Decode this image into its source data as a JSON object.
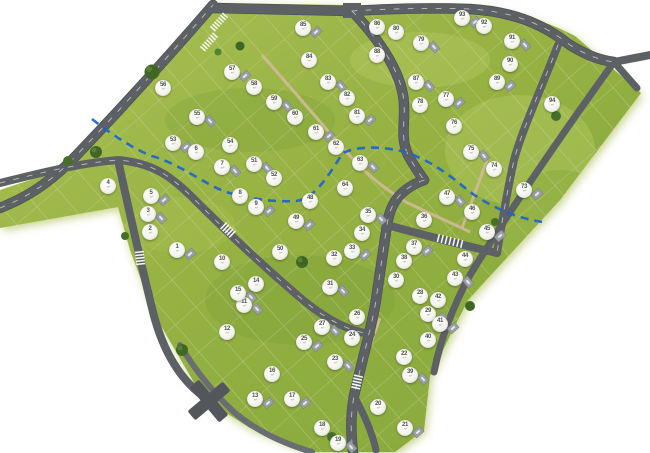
{
  "site_plan": {
    "canvas": {
      "width": 650,
      "height": 453
    },
    "colors": {
      "background": "#ffffff",
      "grass": "#96b243",
      "grass_light": "#b3c75e",
      "grass_dark": "#7fa238",
      "road": "#5d6165",
      "road_secondary": "#6a6e72",
      "footpath": "#cdbb92",
      "utility_line_blue": "#1d64cc",
      "marker_fill": "#f4f4ee",
      "marker_text": "#4e5347",
      "tree": "#46702a"
    },
    "marker_sub_label": "m²",
    "lots": [
      {
        "n": "1",
        "x": 177,
        "y": 250
      },
      {
        "n": "2",
        "x": 150,
        "y": 232
      },
      {
        "n": "3",
        "x": 148,
        "y": 214
      },
      {
        "n": "4",
        "x": 108,
        "y": 186
      },
      {
        "n": "5",
        "x": 151,
        "y": 196
      },
      {
        "n": "6",
        "x": 196,
        "y": 152
      },
      {
        "n": "7",
        "x": 222,
        "y": 167
      },
      {
        "n": "8",
        "x": 240,
        "y": 196
      },
      {
        "n": "9",
        "x": 256,
        "y": 207
      },
      {
        "n": "10",
        "x": 222,
        "y": 262
      },
      {
        "n": "11",
        "x": 244,
        "y": 305
      },
      {
        "n": "12",
        "x": 227,
        "y": 332
      },
      {
        "n": "13",
        "x": 255,
        "y": 399
      },
      {
        "n": "14",
        "x": 256,
        "y": 284
      },
      {
        "n": "15",
        "x": 238,
        "y": 293
      },
      {
        "n": "16",
        "x": 272,
        "y": 374
      },
      {
        "n": "17",
        "x": 292,
        "y": 399
      },
      {
        "n": "18",
        "x": 322,
        "y": 428
      },
      {
        "n": "19",
        "x": 338,
        "y": 443
      },
      {
        "n": "20",
        "x": 378,
        "y": 407
      },
      {
        "n": "21",
        "x": 405,
        "y": 428
      },
      {
        "n": "22",
        "x": 404,
        "y": 357
      },
      {
        "n": "23",
        "x": 335,
        "y": 362
      },
      {
        "n": "24",
        "x": 352,
        "y": 338
      },
      {
        "n": "25",
        "x": 304,
        "y": 342
      },
      {
        "n": "26",
        "x": 357,
        "y": 317
      },
      {
        "n": "27",
        "x": 322,
        "y": 327
      },
      {
        "n": "28",
        "x": 420,
        "y": 296
      },
      {
        "n": "29",
        "x": 428,
        "y": 314
      },
      {
        "n": "30",
        "x": 396,
        "y": 280
      },
      {
        "n": "31",
        "x": 330,
        "y": 287
      },
      {
        "n": "32",
        "x": 334,
        "y": 258
      },
      {
        "n": "33",
        "x": 352,
        "y": 251
      },
      {
        "n": "34",
        "x": 362,
        "y": 233
      },
      {
        "n": "35",
        "x": 368,
        "y": 215
      },
      {
        "n": "36",
        "x": 424,
        "y": 220
      },
      {
        "n": "37",
        "x": 414,
        "y": 247
      },
      {
        "n": "38",
        "x": 404,
        "y": 261
      },
      {
        "n": "39",
        "x": 410,
        "y": 375
      },
      {
        "n": "40",
        "x": 428,
        "y": 340
      },
      {
        "n": "41",
        "x": 440,
        "y": 324
      },
      {
        "n": "42",
        "x": 438,
        "y": 300
      },
      {
        "n": "43",
        "x": 455,
        "y": 278
      },
      {
        "n": "44",
        "x": 465,
        "y": 259
      },
      {
        "n": "45",
        "x": 487,
        "y": 232
      },
      {
        "n": "46",
        "x": 472,
        "y": 212
      },
      {
        "n": "47",
        "x": 447,
        "y": 197
      },
      {
        "n": "48",
        "x": 310,
        "y": 201
      },
      {
        "n": "49",
        "x": 296,
        "y": 221
      },
      {
        "n": "50",
        "x": 280,
        "y": 252
      },
      {
        "n": "51",
        "x": 254,
        "y": 164
      },
      {
        "n": "52",
        "x": 274,
        "y": 178
      },
      {
        "n": "53",
        "x": 173,
        "y": 143
      },
      {
        "n": "54",
        "x": 230,
        "y": 145
      },
      {
        "n": "55",
        "x": 197,
        "y": 117
      },
      {
        "n": "56",
        "x": 163,
        "y": 88
      },
      {
        "n": "57",
        "x": 232,
        "y": 72
      },
      {
        "n": "58",
        "x": 254,
        "y": 87
      },
      {
        "n": "59",
        "x": 274,
        "y": 102
      },
      {
        "n": "60",
        "x": 295,
        "y": 117
      },
      {
        "n": "61",
        "x": 316,
        "y": 132
      },
      {
        "n": "62",
        "x": 336,
        "y": 147
      },
      {
        "n": "63",
        "x": 360,
        "y": 163
      },
      {
        "n": "64",
        "x": 345,
        "y": 188
      },
      {
        "n": "73",
        "x": 524,
        "y": 190
      },
      {
        "n": "74",
        "x": 494,
        "y": 169
      },
      {
        "n": "75",
        "x": 471,
        "y": 152
      },
      {
        "n": "76",
        "x": 454,
        "y": 126
      },
      {
        "n": "77",
        "x": 446,
        "y": 99
      },
      {
        "n": "78",
        "x": 420,
        "y": 105
      },
      {
        "n": "79",
        "x": 421,
        "y": 43
      },
      {
        "n": "80",
        "x": 396,
        "y": 32
      },
      {
        "n": "81",
        "x": 357,
        "y": 116
      },
      {
        "n": "82",
        "x": 347,
        "y": 98
      },
      {
        "n": "83",
        "x": 328,
        "y": 82
      },
      {
        "n": "84",
        "x": 309,
        "y": 60
      },
      {
        "n": "85",
        "x": 303,
        "y": 28
      },
      {
        "n": "86",
        "x": 377,
        "y": 27
      },
      {
        "n": "87",
        "x": 416,
        "y": 82
      },
      {
        "n": "88",
        "x": 377,
        "y": 55
      },
      {
        "n": "89",
        "x": 497,
        "y": 82
      },
      {
        "n": "90",
        "x": 510,
        "y": 64
      },
      {
        "n": "91",
        "x": 512,
        "y": 41
      },
      {
        "n": "92",
        "x": 484,
        "y": 26
      },
      {
        "n": "93",
        "x": 462,
        "y": 18
      },
      {
        "n": "94",
        "x": 552,
        "y": 104
      }
    ]
  }
}
